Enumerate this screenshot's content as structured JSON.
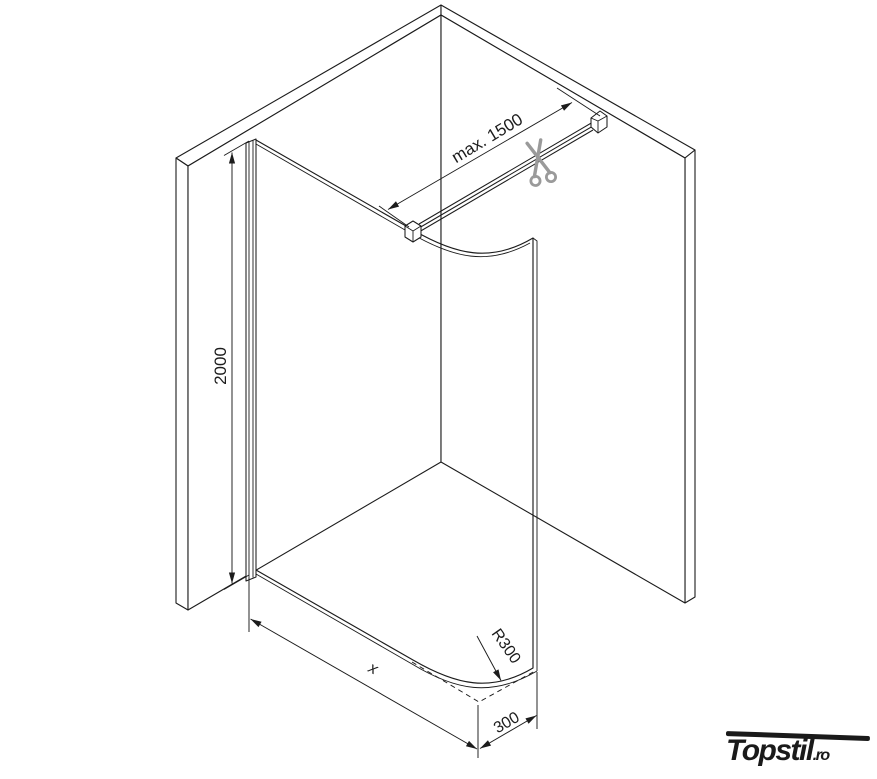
{
  "diagram": {
    "title_hint": "walk-in shower curved glass panel installation drawing",
    "labels": {
      "bar_max_length": "max. 1500",
      "panel_height": "2000",
      "panel_width": "x",
      "corner_radius": "R300",
      "return_depth": "300"
    },
    "icons": {
      "scissors": "scissors-cut-icon"
    },
    "colors": {
      "line": "#1c1c1c",
      "scissors": "#9a9a9a",
      "logo": "#1a1a1a",
      "background": "#ffffff"
    }
  },
  "logo": {
    "brand": "Topstil",
    "suffix": ".ro"
  }
}
